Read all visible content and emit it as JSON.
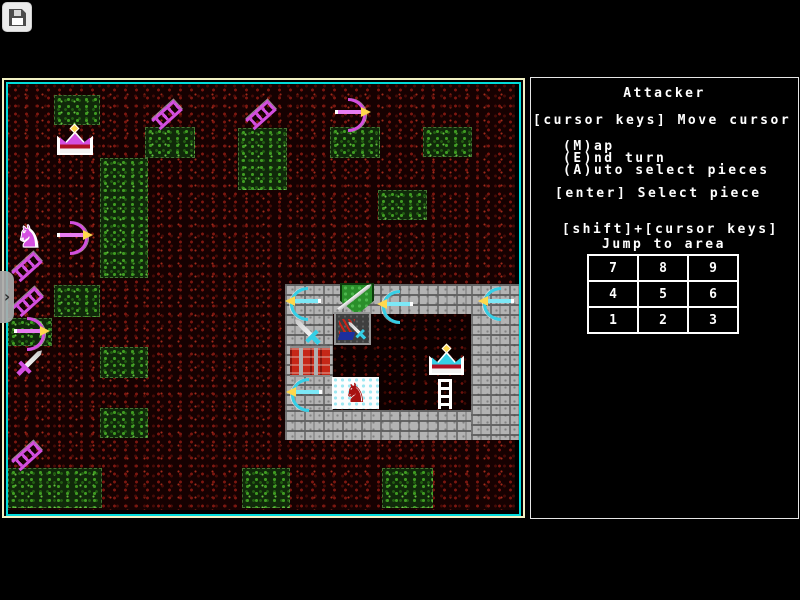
{
  "toolbar": {
    "save_icon": "floppy-disk-icon"
  },
  "side_tab": {
    "chevron_icon": "chevron-right-icon",
    "glyph": "›"
  },
  "panel": {
    "title": "Attacker",
    "cursor_help": "[cursor keys] Move cursor",
    "menu_items": [
      "(M)ap",
      "(E)nd turn",
      "(A)uto select pieces"
    ],
    "enter_help": "[enter] Select piece",
    "shift_help": "[shift]+[cursor keys]",
    "jump_help": "Jump to area",
    "keypad_rows": [
      [
        "7",
        "8",
        "9"
      ],
      [
        "4",
        "5",
        "6"
      ],
      [
        "1",
        "2",
        "3"
      ]
    ]
  },
  "colors": {
    "map_border_outer": "#f2f2c4",
    "map_border_inner": "#00dcdc",
    "panel_border": "#e6e6e6",
    "attacker_piece": "#d44fe0",
    "defender_piece": "#35cfe6",
    "arrow_tip": "#ffd84d",
    "terrain_speckle": "#7d1710",
    "grass_speckle": "#3f9c22",
    "castle_brick": "#b3b3b3",
    "gate_red": "#c62717",
    "cursor_tile": "#fdfdfd",
    "cursor_horse": "#a81212"
  },
  "map": {
    "green_patches": [
      [
        54,
        95,
        46,
        30
      ],
      [
        145,
        127,
        50,
        31
      ],
      [
        100,
        158,
        48,
        120
      ],
      [
        238,
        128,
        49,
        62
      ],
      [
        330,
        127,
        50,
        31
      ],
      [
        423,
        127,
        49,
        30
      ],
      [
        378,
        190,
        49,
        30
      ],
      [
        54,
        285,
        46,
        32
      ],
      [
        8,
        318,
        44,
        28
      ],
      [
        100,
        347,
        48,
        31
      ],
      [
        100,
        408,
        48,
        30
      ],
      [
        8,
        468,
        94,
        40
      ],
      [
        242,
        468,
        48,
        40
      ],
      [
        382,
        468,
        51,
        40
      ]
    ],
    "castle": {
      "walls": [
        [
          285,
          284,
          234,
          30
        ],
        [
          285,
          284,
          48,
          156
        ],
        [
          285,
          410,
          234,
          30
        ],
        [
          471,
          284,
          48,
          156
        ]
      ],
      "courtyard": [
        333,
        314,
        138,
        96
      ]
    },
    "sprites": [
      {
        "type": "crown",
        "piece": "attacker-king",
        "color": "magenta",
        "x": 57,
        "y": 129
      },
      {
        "type": "ladder",
        "piece": "attacker-ladder",
        "color": "magenta",
        "x": 160,
        "y": 100
      },
      {
        "type": "ladder",
        "piece": "attacker-ladder",
        "color": "magenta",
        "x": 254,
        "y": 100
      },
      {
        "type": "bow",
        "piece": "attacker-archer",
        "color": "magenta",
        "dir": "right",
        "x": 335,
        "y": 98
      },
      {
        "type": "horse",
        "piece": "attacker-knight",
        "color": "magenta",
        "x": 10,
        "y": 221
      },
      {
        "type": "bow",
        "piece": "attacker-archer",
        "color": "magenta",
        "dir": "right",
        "x": 57,
        "y": 221
      },
      {
        "type": "ladder",
        "piece": "attacker-ladder",
        "color": "magenta",
        "x": 20,
        "y": 252
      },
      {
        "type": "ladder",
        "piece": "attacker-ladder",
        "color": "magenta",
        "x": 21,
        "y": 287
      },
      {
        "type": "bow",
        "piece": "attacker-archer",
        "color": "magenta",
        "dir": "right",
        "x": 14,
        "y": 317
      },
      {
        "type": "sword",
        "piece": "attacker-swordsman",
        "color": "magenta",
        "x": 11,
        "y": 344
      },
      {
        "type": "ladder",
        "piece": "attacker-ladder",
        "color": "magenta",
        "x": 20,
        "y": 441
      },
      {
        "type": "bow",
        "piece": "defender-archer",
        "color": "cyan",
        "dir": "left",
        "x": 285,
        "y": 287
      },
      {
        "type": "shield",
        "piece": "defender-shield",
        "color": "green",
        "x": 336,
        "y": 283
      },
      {
        "type": "bow",
        "piece": "defender-archer",
        "color": "cyan",
        "dir": "left",
        "x": 377,
        "y": 290
      },
      {
        "type": "bow",
        "piece": "defender-archer",
        "color": "cyan",
        "dir": "left",
        "x": 478,
        "y": 287
      },
      {
        "type": "sword",
        "piece": "defender-swordsman",
        "color": "cyan",
        "dir": "nw",
        "x": 286,
        "y": 313
      },
      {
        "type": "unit-tile",
        "piece": "defender-unit-tile",
        "x": 334,
        "y": 312,
        "w": 37,
        "h": 33
      },
      {
        "type": "sword",
        "piece": "defender-swordsman",
        "color": "cyan",
        "dir": "nw",
        "small": true,
        "x": 336,
        "y": 312
      },
      {
        "type": "gate",
        "piece": "castle-gate",
        "x": 290,
        "y": 346,
        "w": 40,
        "h": 31
      },
      {
        "type": "bow",
        "piece": "defender-archer",
        "color": "cyan",
        "dir": "left",
        "x": 286,
        "y": 378
      },
      {
        "type": "cursor-tile",
        "piece": "selected-knight",
        "x": 332,
        "y": 377,
        "w": 47,
        "h": 32
      },
      {
        "type": "crown",
        "piece": "defender-king",
        "color": "cyan",
        "x": 429,
        "y": 349,
        "w": 35,
        "h": 26
      },
      {
        "type": "ladder",
        "piece": "defender-ladder",
        "color": "white",
        "x": 438,
        "y": 379
      }
    ]
  }
}
